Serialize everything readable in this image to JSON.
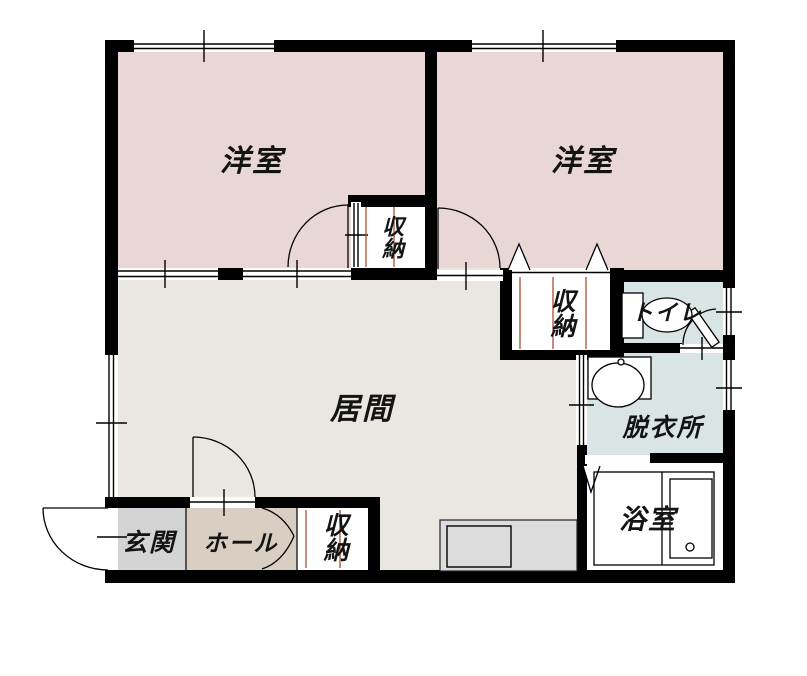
{
  "plan": {
    "type": "floor-plan",
    "rooms": {
      "bedroom1": {
        "label": "洋室"
      },
      "bedroom2": {
        "label": "洋室"
      },
      "living": {
        "label": "居間"
      },
      "closet1": {
        "label": "収納"
      },
      "closet2": {
        "label": "収納"
      },
      "hall_closet": {
        "label": "収納"
      },
      "toilet": {
        "label": "トイレ"
      },
      "dressing": {
        "label": "脱衣所"
      },
      "bath": {
        "label": "浴室"
      },
      "entrance": {
        "label": "玄関"
      },
      "hall": {
        "label": "ホール"
      }
    }
  },
  "colors": {
    "wall": "#000000",
    "bedroom": "#e8d7d5",
    "living": "#eae7e0",
    "wet_area": "#d9e5e4",
    "entrance": "#d4d4d4",
    "hall": "#d8cfc2",
    "closet": "#ffffff",
    "bath": "#ffffff",
    "counter": "#dcdcdc",
    "sink": "#dcdcdc",
    "sliding_track": "#a8522f",
    "line": "#000000"
  }
}
